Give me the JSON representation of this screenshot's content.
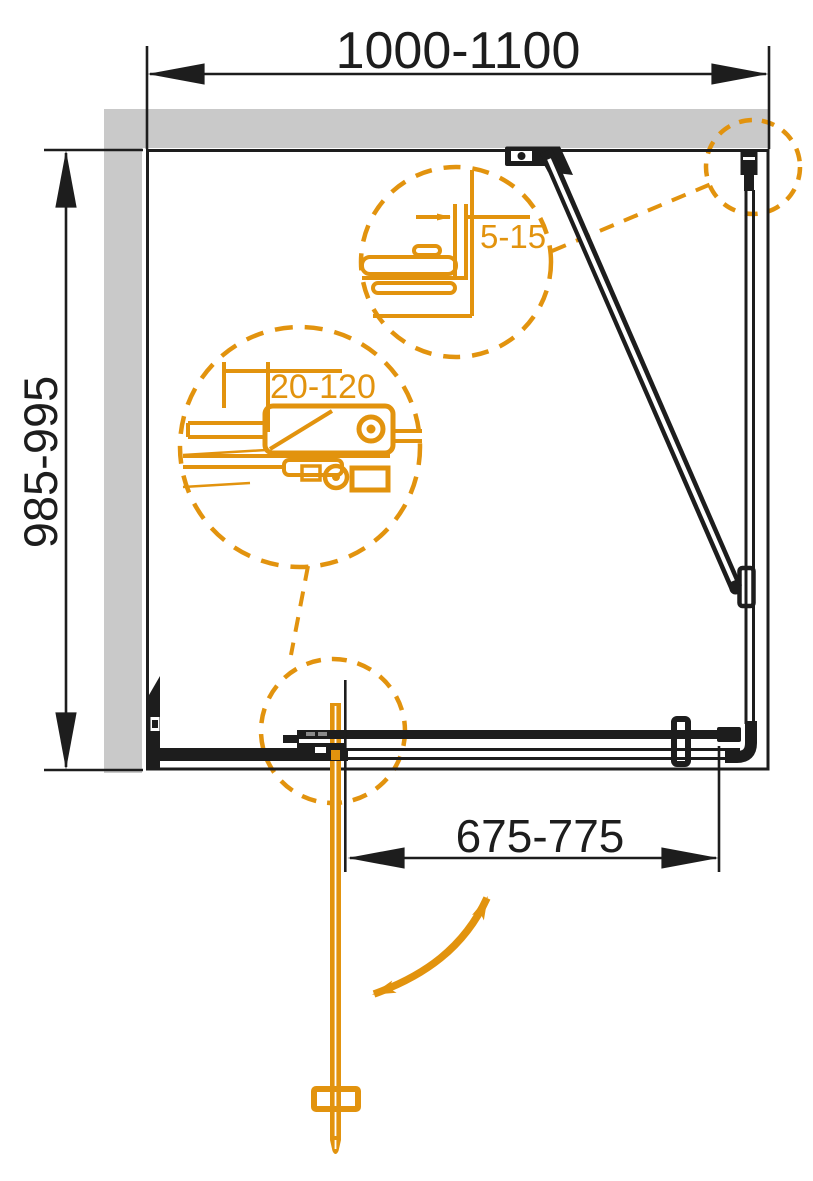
{
  "title": "Shower enclosure installation diagram (top view)",
  "colors": {
    "accent_orange": "#e2930e",
    "wall_gray": "#c9c9c9",
    "line_black": "#1d1d1d"
  },
  "dimensions": {
    "width_top": "1000-1100",
    "height_left": "985-995",
    "door_opening_bottom": "675-775",
    "wall_profile_gap": "5-15",
    "adjustment_range": "20-120"
  }
}
